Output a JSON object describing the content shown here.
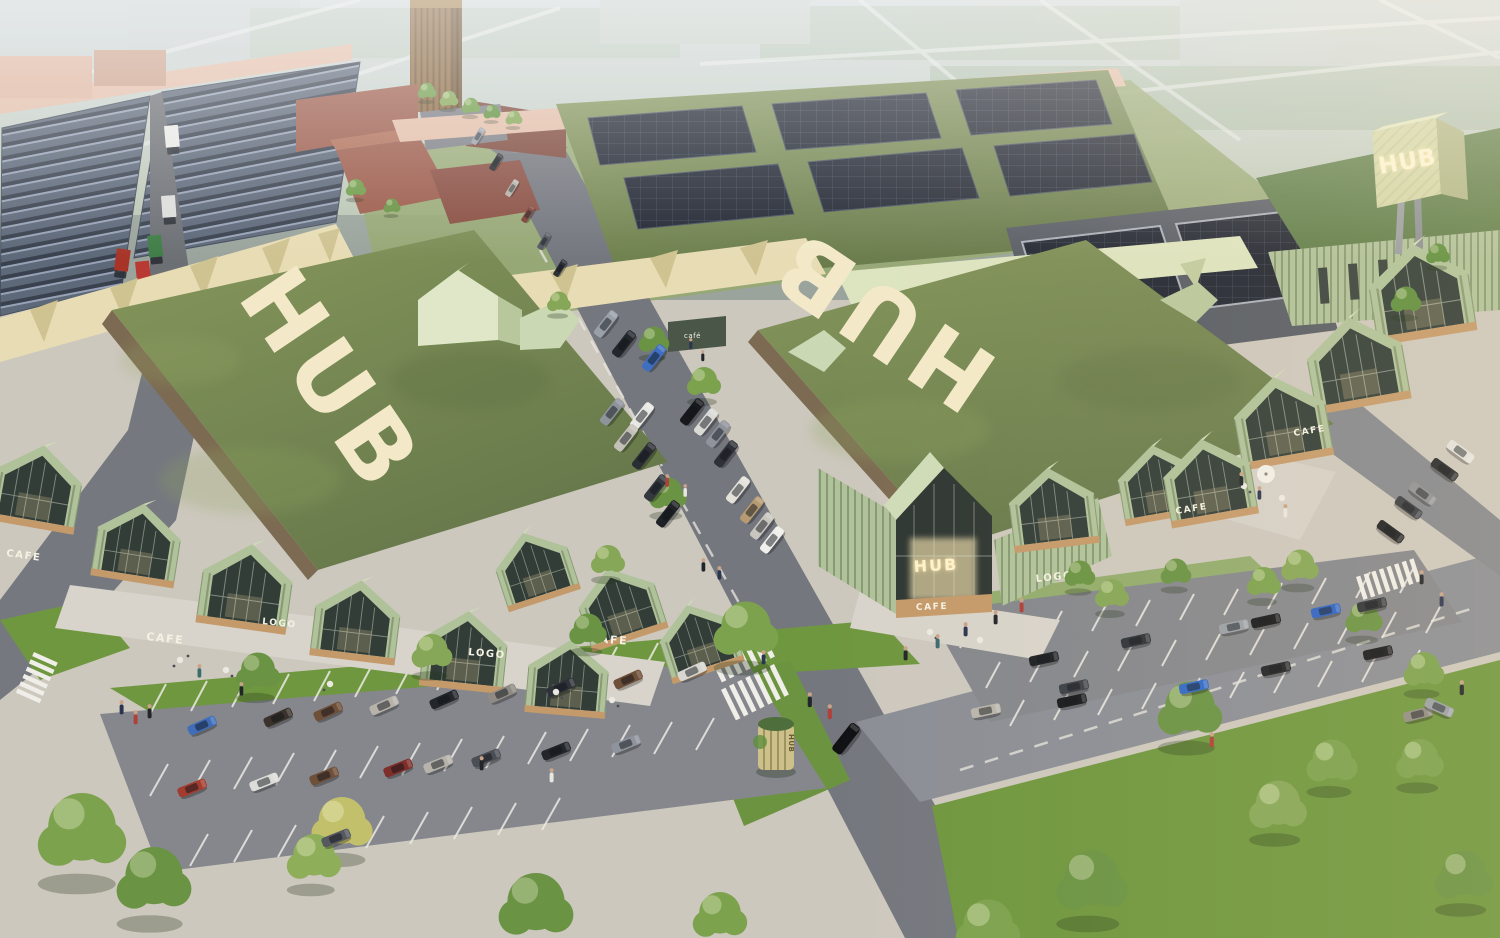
{
  "scene": {
    "title": "HUB retail park — aerial architectural rendering",
    "type": "architectural-visualization",
    "time_of_day": "late afternoon"
  },
  "branding": {
    "name": "HUB"
  },
  "signs": {
    "roof_left": "HUB",
    "roof_right": "HUB",
    "pylon_front": "HUB",
    "pylon_side": "HUB",
    "entrance": "HUB",
    "totem": "HUB",
    "cafe": "CAFE",
    "cafe_small": "café",
    "logo": "LOGO"
  },
  "palette": {
    "haze_sky": "#cdd5d8",
    "grass_roof": "#78894f",
    "lawn": "#6f973f",
    "sage_cladding": "#b0c29a",
    "cream_units": "#e7dcb4",
    "pink_walls": "#e2bda8",
    "brick": "#9c5c4c",
    "solar_panel": "#262c37",
    "asphalt": "#83868d",
    "paving": "#cdc8be",
    "timber": "#c59a6b",
    "sign_letters": "#f4ebcb"
  }
}
